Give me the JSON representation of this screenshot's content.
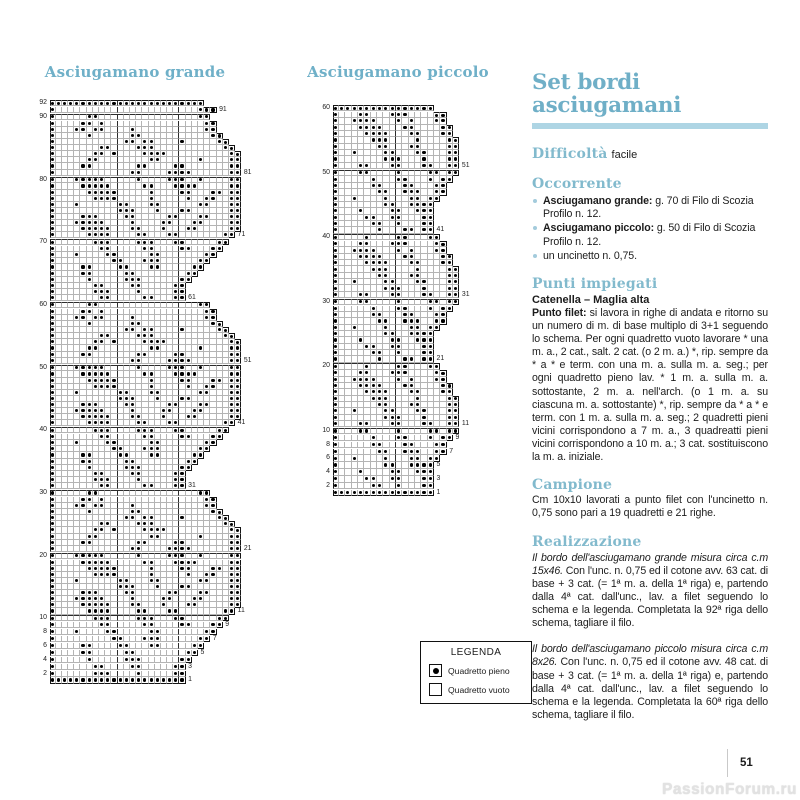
{
  "page": {
    "number": "51",
    "watermark": "PassionForum.ru"
  },
  "colors": {
    "teal_title": "#6fafc7",
    "teal_heading": "#82bacd",
    "bar": "#aed5e4",
    "bullet": "#a3cbdc",
    "grid_line": "#b4b4b4",
    "ink": "#1c1c1c"
  },
  "charts": {
    "large": {
      "title": "Asciugamano grande",
      "left_labels": [
        92,
        90,
        80,
        70,
        60,
        50,
        40,
        30,
        20,
        10,
        8,
        6,
        4,
        2
      ],
      "right_labels": [
        91,
        81,
        71,
        61,
        51,
        41,
        31,
        21,
        11,
        9,
        7,
        5,
        3,
        1
      ],
      "bold_after_cols": [
        10,
        20
      ],
      "rows": [
        "1111111111111111111111111",
        "100000000000000000000000111",
        "10000011000000000000000011",
        "100001101000000000000000011",
        "100011011000010000000000011",
        "1000001000000110000000000011",
        "10000000000011011000010000011",
        "100000001100001110000000000011",
        "1000000110100001111000000000011",
        "1000001100000000110000001000011",
        "1000011000000011000011000000011",
        "1000000000000110000111100000011",
        "1000111110000010000111001000011",
        "1000011111000001100011110000011",
        "1000001111100000100001100011011",
        "1000000111100000100000100110011",
        "1000100000011000110000001100011",
        "1000000000011100010001100000011",
        "1000011100001100000110001100011",
        "1000111110000100001100011000011",
        "1000011111000110001000110000011",
        "100000111100001100011000000011",
        "10000001110000111000110000011",
        "1000000011000001100001100011",
        "100010000110000011000000011",
        "10000000001100011100000011",
        "1000011000011000110000011",
        "100001100000110000000011",
        "10000010000011100000011",
        "1000000110000110000011",
        "1000000111000010000011",
        "1000000011000001100011",
        "10000011000000000000000011",
        "100001101000000000000000011",
        "100011011000010000000000011",
        "1000001000000110000000000011",
        "10000000000011011000010000011",
        "100000001100001110000000000011",
        "1000000110100001111000000000011",
        "1000001100000000110000001000011",
        "1000011000000011000011000000011",
        "1000000000000110000111100000011",
        "1000111110000010000111001000011",
        "1000011111000001100011110000011",
        "1000001111100000100001100011011",
        "1000000111100000100000100110011",
        "1000100000011000110000001100011",
        "1000000000011100010001100000011",
        "1000011100001100000110001100011",
        "1000111110000100001100011000011",
        "1000011111000110001000110000011",
        "100000111100001100011000000011",
        "10000001110000111000110000011",
        "1000000011000001100001100011",
        "100010000110000011000000011",
        "10000000001100011100000011",
        "1000011000011000110000011",
        "100001100000110000000011",
        "10000010000011100000011",
        "1000000110000110000011",
        "1000000111000010000011",
        "1000000011000001100011",
        "10000011000000000000000011",
        "100001101000000000000000011",
        "100011011000010000000000011",
        "1000001000000110000000000011",
        "10000000000011011000010000011",
        "100000001100001110000000000011",
        "1000000110100001111000000000011",
        "1000001100000000110000001000011",
        "1000011000000011000011000000011",
        "1000000000000110000111100000011",
        "1000111110000010000111001000011",
        "1000011111000001100011110000011",
        "1000001111100000100001100011011",
        "1000000111100000100000100110011",
        "1000100000011000110000001100011",
        "1000000000011100010001100000011",
        "1000011100001100000110001100011",
        "1000111110000100001100011000011",
        "1000011111000110001000110000011",
        "100000111100001100011000000011",
        "10000001110000111000110000011",
        "1000000011000001100001100011",
        "100010000110000011000000011",
        "10000000001100011100000011",
        "1000011000011000110000011",
        "100001100000110000000011",
        "10000010000011100000011",
        "1000000110000110000011",
        "1000000111000010000011",
        "1111111111111111111111"
      ]
    },
    "small": {
      "title": "Asciugamano piccolo",
      "left_labels": [
        60,
        50,
        40,
        30,
        20,
        10,
        8,
        6,
        4,
        2
      ],
      "right_labels": [
        51,
        41,
        31,
        21,
        11,
        9,
        7,
        5,
        3,
        1
      ],
      "bold_after_cols": [
        9
      ],
      "rows": [
        "1111111111111111",
        "100011000111000011",
        "100111100010100011",
        "1000111100011000011",
        "1000011110001100011",
        "10000011100001000011",
        "10000001100011000011",
        "10010000110001100011",
        "10000000111000100011",
        "10001100011000110011",
        "10001100001000011011",
        "1000001000110001011",
        "100000110001100011",
        "100000011001110011",
        "10010000100011011",
        "1000000011001111",
        "1000100001100111",
        "1000011001100011",
        "1000001100100011",
        "1000000100011011",
        "10000100001100011",
        "100011000111000011",
        "100111100010100011",
        "1000111100011000011",
        "1000011110001100011",
        "10000011100001000011",
        "10000001100011000011",
        "10010000110001100011",
        "10000000111000100011",
        "10001100011000110011",
        "10001100001000011011",
        "1000001000110001011",
        "100000110001100011",
        "100000011001110011",
        "10010000100011011",
        "1000000011001111",
        "1000100001100111",
        "1000011001100011",
        "1000001100100011",
        "1000000100011011",
        "10000100001100011",
        "100011000111000011",
        "100111100010100011",
        "1000111100011000011",
        "1000011110001100011",
        "10000011100001000011",
        "10000001100011000011",
        "10010000110001100011",
        "10000000111000100011",
        "10001100011000110011",
        "10001100001000011011",
        "1000001000110001011",
        "100000110001100011",
        "100000011001110011",
        "10010000100011011",
        "1000000011001111",
        "1000100001100111",
        "1000011001100011",
        "1000001100100011",
        "1111111111111111"
      ]
    }
  },
  "legend": {
    "title": "LEGENDA",
    "items": [
      {
        "icon": "filled-square-icon",
        "label": "Quadretto pieno"
      },
      {
        "icon": "empty-square-icon",
        "label": "Quadretto vuoto"
      }
    ]
  },
  "article": {
    "title": "Set bordi asciugamani",
    "difficulty_label": "Difficoltà",
    "difficulty_value": "facile",
    "occorrente_label": "Occorrente",
    "occorrente_items": [
      {
        "lead": "Asciugamano grande:",
        "text": "g. 70 di Filo di Scozia Profilo n. 12."
      },
      {
        "lead": "Asciugamano piccolo:",
        "text": "g. 50 di Filo di Scozia Profilo n. 12."
      },
      {
        "lead": "",
        "text": "un uncinetto n. 0,75."
      }
    ],
    "punti_label": "Punti impiegati",
    "punti_sub": "Catenella – Maglia alta",
    "punti_lead": "Punto filet:",
    "punti_text": "si lavora in righe di andata e ritorno su un numero di m. di base multiplo di 3+1 seguendo lo schema. Per ogni quadretto vuoto lavorare * una m. a., 2 cat., salt. 2 cat. (o 2 m. a.) *, rip. sempre da * a * e term. con una m. a. sulla m. a. seg.; per ogni quadretto pieno lav. * 1 m. a. sulla m. a. sottostante, 2 m. a. nell'arch. (o 1 m. a. su ciascuna m. a. sottostante) *, rip. sempre da * a * e term. con 1 m. a. sulla m. a. seg.; 2 quadretti pieni vicini corrispondono a 7 m. a., 3 quadreatti pieni vicini corrispondono a 10 m. a.; 3 cat. sostituiscono la m. a. iniziale.",
    "campione_label": "Campione",
    "campione_text": "Cm 10x10 lavorati a punto filet con l'uncinetto n. 0,75 sono pari a 19 quadretti e 21 righe.",
    "realizzazione_label": "Realizzazione",
    "realizzazione_paras": [
      {
        "lead": "Il bordo dell'asciugamano grande misura circa c.m 15x46.",
        "text": "Con l'unc. n. 0,75 ed il cotone avv. 63 cat. di base + 3 cat. (= 1ª m. a. della 1ª riga) e, partendo dalla 4ª cat. dall'unc., lav. a filet seguendo lo schema e la legenda. Completata la 92ª riga dello schema, tagliare il filo."
      },
      {
        "lead": "Il bordo dell'asciugamano piccolo misura circa c.m 8x26.",
        "text": "Con l'unc. n. 0,75 ed il cotone avv. 48 cat. di base + 3 cat. (= 1ª m. a. della 1ª riga) e, partendo dalla 4ª cat. dall'unc., lav. a filet seguendo lo schema e la legenda. Completata la 60ª riga dello schema, tagliare il filo."
      }
    ]
  }
}
